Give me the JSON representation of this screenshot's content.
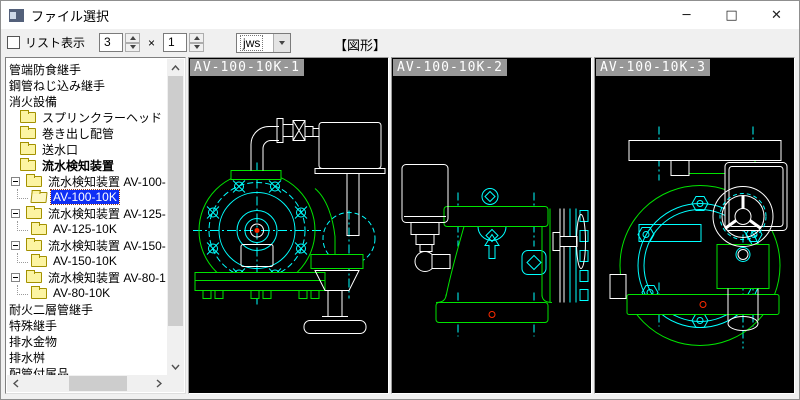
{
  "window": {
    "title": "ファイル選択",
    "controls": {
      "minimize": "─",
      "maximize": "□",
      "close": "✕"
    }
  },
  "toolbar": {
    "list_checkbox_label": "リスト表示",
    "cols_value": "3",
    "times_label": "×",
    "rows_value": "1",
    "filetype_value": "jws",
    "figure_label": "【図形】"
  },
  "tree": {
    "items": [
      {
        "label": "管端防食継手",
        "type": "text"
      },
      {
        "label": "鋼管ねじ込み継手",
        "type": "text"
      },
      {
        "label": "消火設備",
        "type": "text"
      },
      {
        "label": "スプリンクラーヘッド",
        "type": "folder",
        "indent": 1
      },
      {
        "label": "巻き出し配管",
        "type": "folder",
        "indent": 1
      },
      {
        "label": "送水口",
        "type": "folder",
        "indent": 1
      },
      {
        "label": "流水検知装置",
        "type": "folder",
        "indent": 1,
        "bold": true
      },
      {
        "label": "流水検知装置 AV-100-",
        "type": "folder",
        "indent": 1,
        "expander": true
      },
      {
        "label": "AV-100-10K",
        "type": "folder-open",
        "indent": 2,
        "selected": true
      },
      {
        "label": "流水検知装置 AV-125-",
        "type": "folder",
        "indent": 1,
        "expander": true
      },
      {
        "label": "AV-125-10K",
        "type": "folder",
        "indent": 2
      },
      {
        "label": "流水検知装置 AV-150-",
        "type": "folder",
        "indent": 1,
        "expander": true
      },
      {
        "label": "AV-150-10K",
        "type": "folder",
        "indent": 2
      },
      {
        "label": "流水検知装置 AV-80-1",
        "type": "folder",
        "indent": 1,
        "expander": true
      },
      {
        "label": "AV-80-10K",
        "type": "folder",
        "indent": 2
      },
      {
        "label": "耐火二層管継手",
        "type": "text"
      },
      {
        "label": "特殊継手",
        "type": "text"
      },
      {
        "label": "排水金物",
        "type": "text"
      },
      {
        "label": "排水桝",
        "type": "text"
      },
      {
        "label": "配管付属品",
        "type": "text"
      }
    ]
  },
  "panels": [
    {
      "label": "AV-100-10K-1"
    },
    {
      "label": "AV-100-10K-2"
    },
    {
      "label": "AV-100-10K-3"
    }
  ],
  "colors": {
    "cad_green": "#00e400",
    "cad_cyan": "#00ffff",
    "cad_white": "#ffffff",
    "cad_red": "#ff2a00",
    "canvas": "#000000",
    "selection_blue": "#0f2ff5",
    "chip_gray": "#989898"
  }
}
